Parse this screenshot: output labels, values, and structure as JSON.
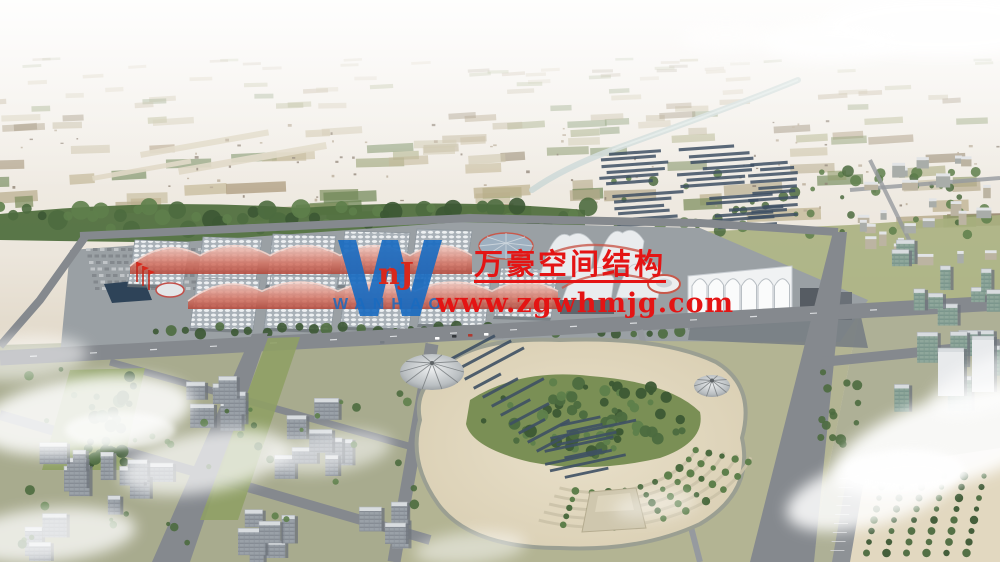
{
  "watermark": {
    "company_name_cn": "万豪空间结构",
    "website": "www.zgwhmjg.com",
    "logo_letter": "W",
    "logo_emblem": "nJ",
    "logo_text": "WANHAO",
    "text_red": "#e41414",
    "logo_blue": "#1a6bc0",
    "emblem_red": "#d8281c"
  },
  "scene": {
    "palette": {
      "skyTop": "#f8f6f3",
      "skyMid": "#ece6dc",
      "landFar": "#d8cdb8",
      "landBase": "#cfc5ae",
      "fields": [
        "#b8ad8e",
        "#a6a87b",
        "#8f9a68",
        "#c3b795",
        "#9b8a6d",
        "#b5a98a",
        "#7e8f5e",
        "#c9c0a4",
        "#a59272",
        "#8a7a5f",
        "#6f8757",
        "#bdb18f"
      ],
      "river": "#ccd8d6",
      "treeDark": "#3c5834",
      "treeMid": "#4c6b3f",
      "treeLight": "#5e7f4b",
      "grass": "#a3ab78",
      "lawn": "#8fa065",
      "concrete": "#9aa0a4",
      "road": "#85898e",
      "roadLight": "#969a9f",
      "hallBase": "#a9b1b8",
      "hallCell": "#edf0f2",
      "hallShadow": "#8d969d",
      "canopyPink": "#eab3a9",
      "canopyRed": "#c8584a",
      "shellWhite": "#e9ecee",
      "panel": "#3e5064",
      "sand": "#e2d8c0",
      "sandDark": "#cfc4a8",
      "bldFace": "#9aa1a8",
      "bldTop": "#d8dcdf",
      "glassFace": "#8fa79b",
      "whiteBld": "#e8eaec",
      "fog": "#ffffff"
    }
  }
}
